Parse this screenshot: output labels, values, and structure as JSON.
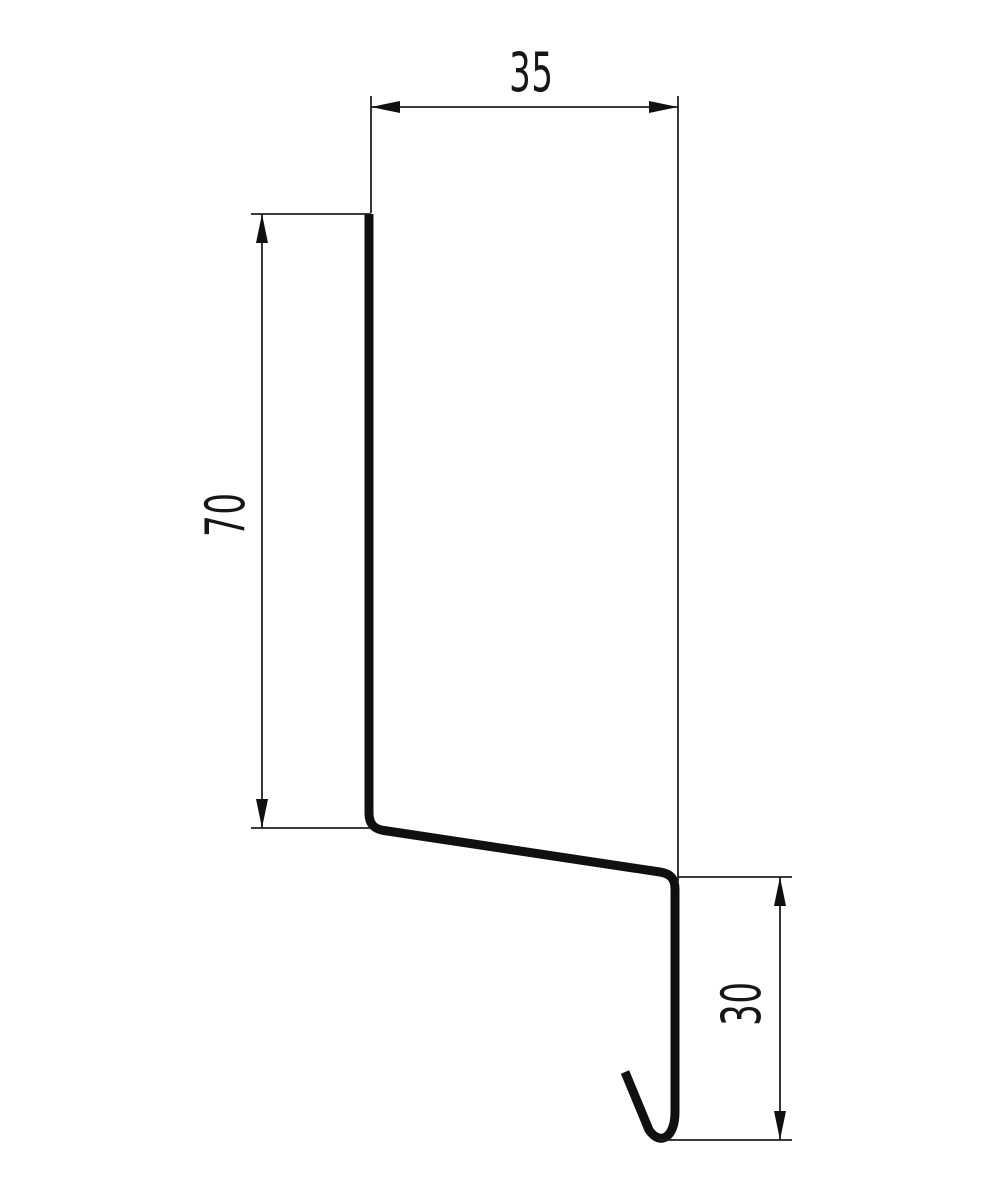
{
  "page": {
    "background_color": "#ffffff",
    "line_color": "#101010"
  },
  "drawing": {
    "dimensions": {
      "top_width": "35",
      "left_height": "70",
      "right_height": "30"
    }
  }
}
